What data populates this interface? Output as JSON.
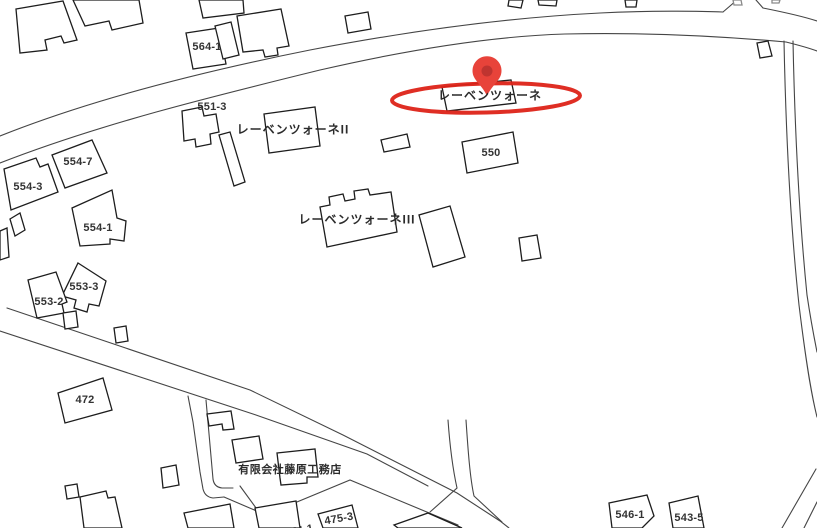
{
  "map": {
    "type": "cadastral-parcel-map",
    "colors": {
      "background": "#ffffff",
      "building_stroke": "#1d1d1d",
      "road_stroke": "#454545",
      "faint_stroke": "#8a8a8a",
      "label_text": "#333333",
      "highlight_red": "#dd2318",
      "pin_red": "#e8433a",
      "pin_inner_red": "#bf3430"
    },
    "marker": {
      "icon": "map-pin-icon",
      "label": "レーベンツォーネ",
      "highlighted": true
    },
    "labels": {
      "parcels": {
        "l564_1": "564-1",
        "l551_3": "551-3",
        "l554_7": "554-7",
        "l554_3": "554-3",
        "l554_1": "554-1",
        "l553_3": "553-3",
        "l553_2": "553-2",
        "l472": "472",
        "l550": "550",
        "l546_1": "546-1",
        "l543_5": "543-5",
        "l475_3": "475-3",
        "l474_1": "474-1"
      },
      "places": {
        "highlight": "レーベンツォーネ",
        "residence2": "レーベンツォーネII",
        "residence3": "レーベンツォーネIII",
        "company": "有限会社藤原工務店"
      }
    }
  }
}
